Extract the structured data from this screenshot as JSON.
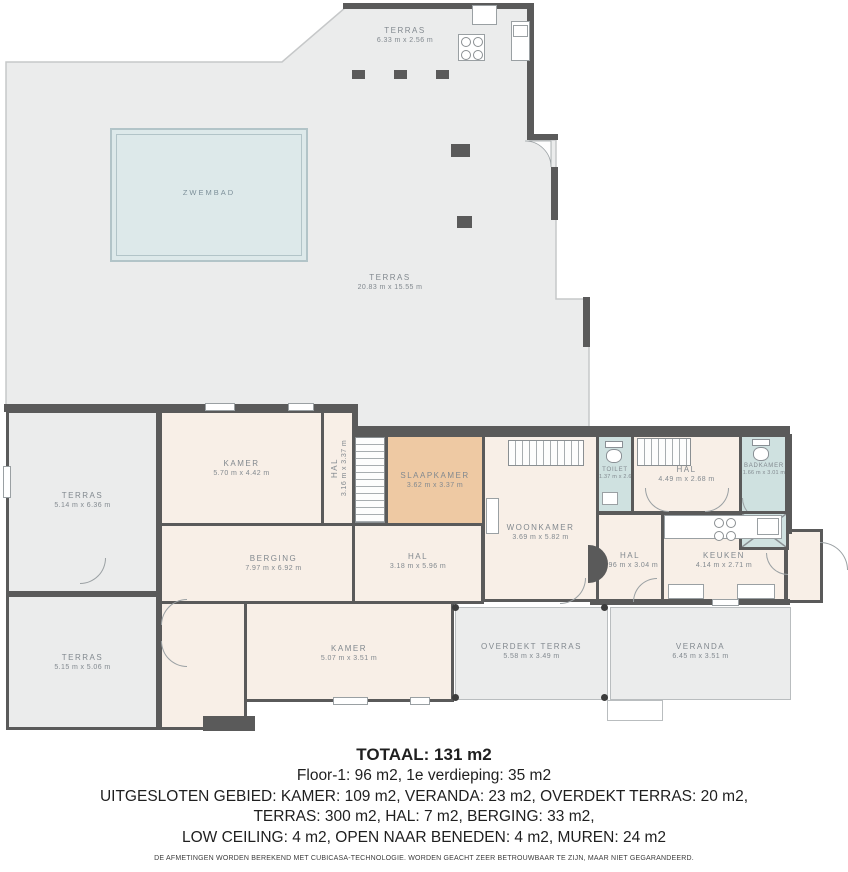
{
  "colors": {
    "wall": "#5a5a5a",
    "terrace_fill": "#ebecec",
    "room_fill": "#f8efe7",
    "bedroom_fill": "#eec9a3",
    "bathroom_fill": "#cfe1e0",
    "pool_fill": "#dde9ea",
    "label_text": "#82898f",
    "summary_text": "#1f1f1f"
  },
  "rooms": [
    {
      "id": "terras-roof",
      "name": "TERRAS",
      "dims": "6.33 m x 2.56 m"
    },
    {
      "id": "zwembad",
      "name": "ZWEMBAD",
      "dims": ""
    },
    {
      "id": "terras-main",
      "name": "TERRAS",
      "dims": "20.83 m x 15.55 m"
    },
    {
      "id": "terras-left-upper",
      "name": "TERRAS",
      "dims": "5.14 m x 6.36 m"
    },
    {
      "id": "kamer-upper",
      "name": "KAMER",
      "dims": "5.70 m x 4.42 m"
    },
    {
      "id": "hal-stairs",
      "name": "HAL",
      "dims": "3.16 m x 3.37 m"
    },
    {
      "id": "slaapkamer",
      "name": "SLAAPKAMER",
      "dims": "3.62 m x 3.37 m"
    },
    {
      "id": "woonkamer",
      "name": "WOONKAMER",
      "dims": "3.69 m x 5.82 m"
    },
    {
      "id": "toilet",
      "name": "TOILET",
      "dims": "1.37 m x 2.68 m"
    },
    {
      "id": "hal-boven",
      "name": "HAL",
      "dims": "4.49 m x 2.68 m"
    },
    {
      "id": "badkamer",
      "name": "BADKAMER",
      "dims": "1.66 m x 3.01 m"
    },
    {
      "id": "berging",
      "name": "BERGING",
      "dims": "7.97 m x 6.92 m"
    },
    {
      "id": "hal-centraal",
      "name": "HAL",
      "dims": "3.18 m x 5.96 m"
    },
    {
      "id": "hal-rechts",
      "name": "HAL",
      "dims": "2.96 m x 3.04 m"
    },
    {
      "id": "keuken",
      "name": "KEUKEN",
      "dims": "4.14 m x 2.71 m"
    },
    {
      "id": "terras-left-lower",
      "name": "TERRAS",
      "dims": "5.15 m x 5.06 m"
    },
    {
      "id": "kamer-lower",
      "name": "KAMER",
      "dims": "5.07 m x 3.51 m"
    },
    {
      "id": "overdekt-terras",
      "name": "OVERDEKT TERRAS",
      "dims": "5.58 m x 3.49 m"
    },
    {
      "id": "veranda",
      "name": "VERANDA",
      "dims": "6.45 m x 3.51 m"
    }
  ],
  "icons": [
    "stove-icon",
    "hood-icon",
    "sink-icon",
    "toilet-icon",
    "shower-icon",
    "stairs-icon",
    "door-arc-icon"
  ],
  "summary": {
    "total": "TOTAAL: 131 m2",
    "floors": "Floor-1: 96 m2, 1e verdieping: 35 m2",
    "excluded1": "UITGESLOTEN GEBIED: KAMER: 109 m2, VERANDA: 23 m2, OVERDEKT TERRAS: 20 m2,",
    "excluded2": "TERRAS: 300 m2, HAL: 7 m2, BERGING: 33 m2,",
    "excluded3": "LOW CEILING: 4 m2, OPEN NAAR BENEDEN: 4 m2, MUREN: 24 m2",
    "disclaimer": "DE AFMETINGEN WORDEN BEREKEND MET CUBICASA-TECHNOLOGIE. WORDEN GEACHT ZEER BETROUWBAAR TE ZIJN, MAAR NIET GEGARANDEERD."
  }
}
